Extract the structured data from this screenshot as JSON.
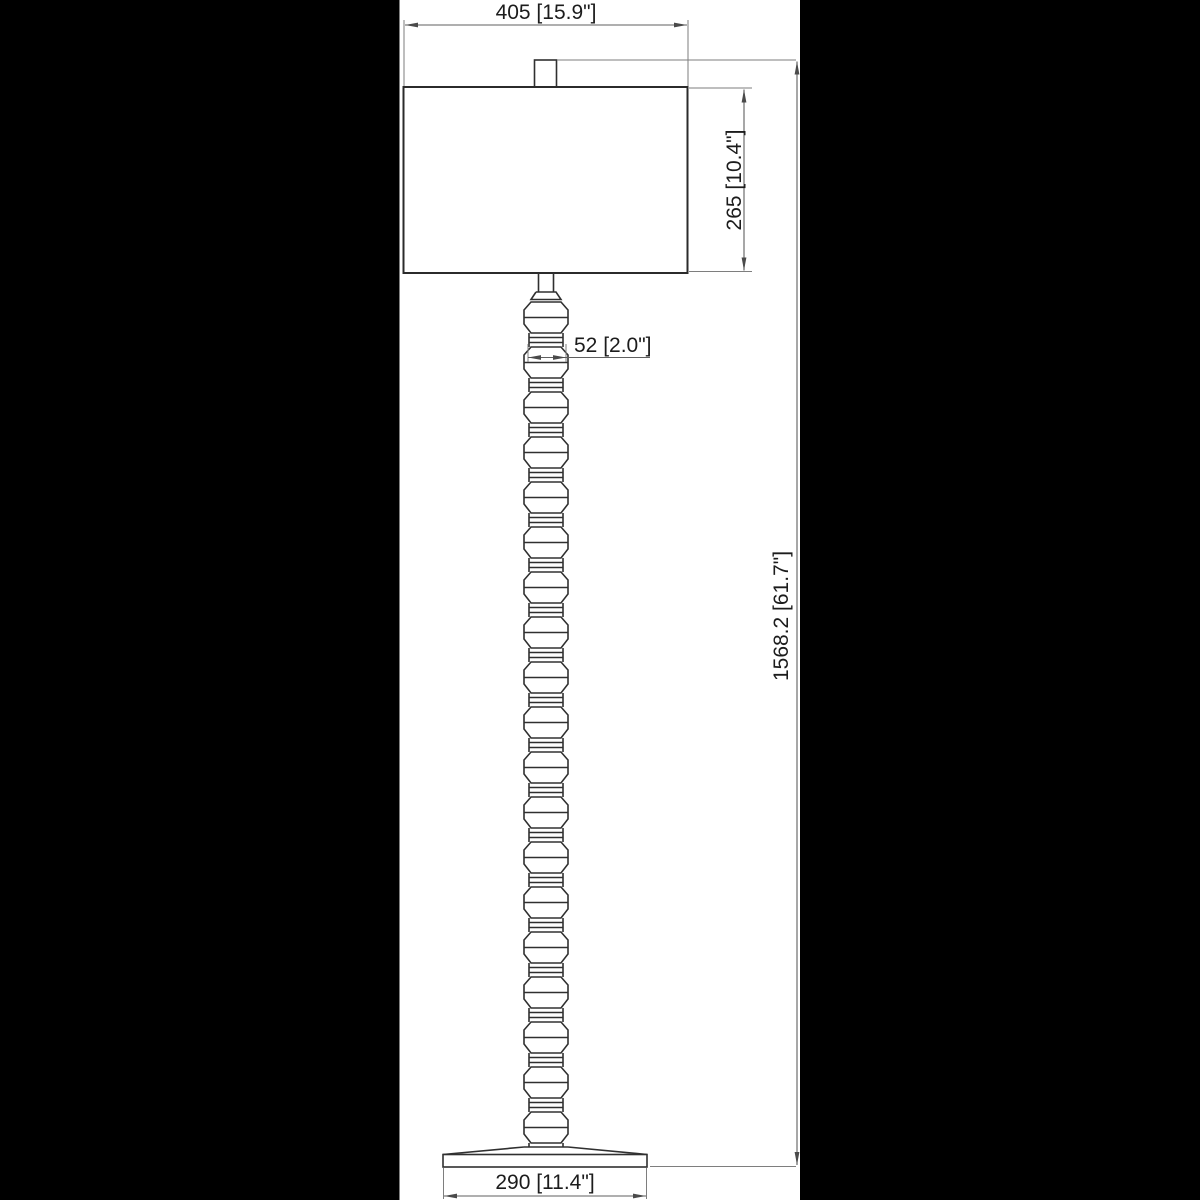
{
  "drawing": {
    "kind": "floor-lamp dimensional drawing",
    "colors": {
      "background": "#000000",
      "paper": "#ffffff",
      "object_line": "#303030",
      "dimension_line": "#5f5f5f",
      "text": "#1c1c1c"
    },
    "labels": {
      "shade_width": "405 [15.9\"]",
      "shade_height": "265 [10.4\"]",
      "column_width": "52 [2.0\"]",
      "overall_height": "1568.2 [61.7\"]",
      "base_width": "290 [11.4\"]"
    }
  }
}
